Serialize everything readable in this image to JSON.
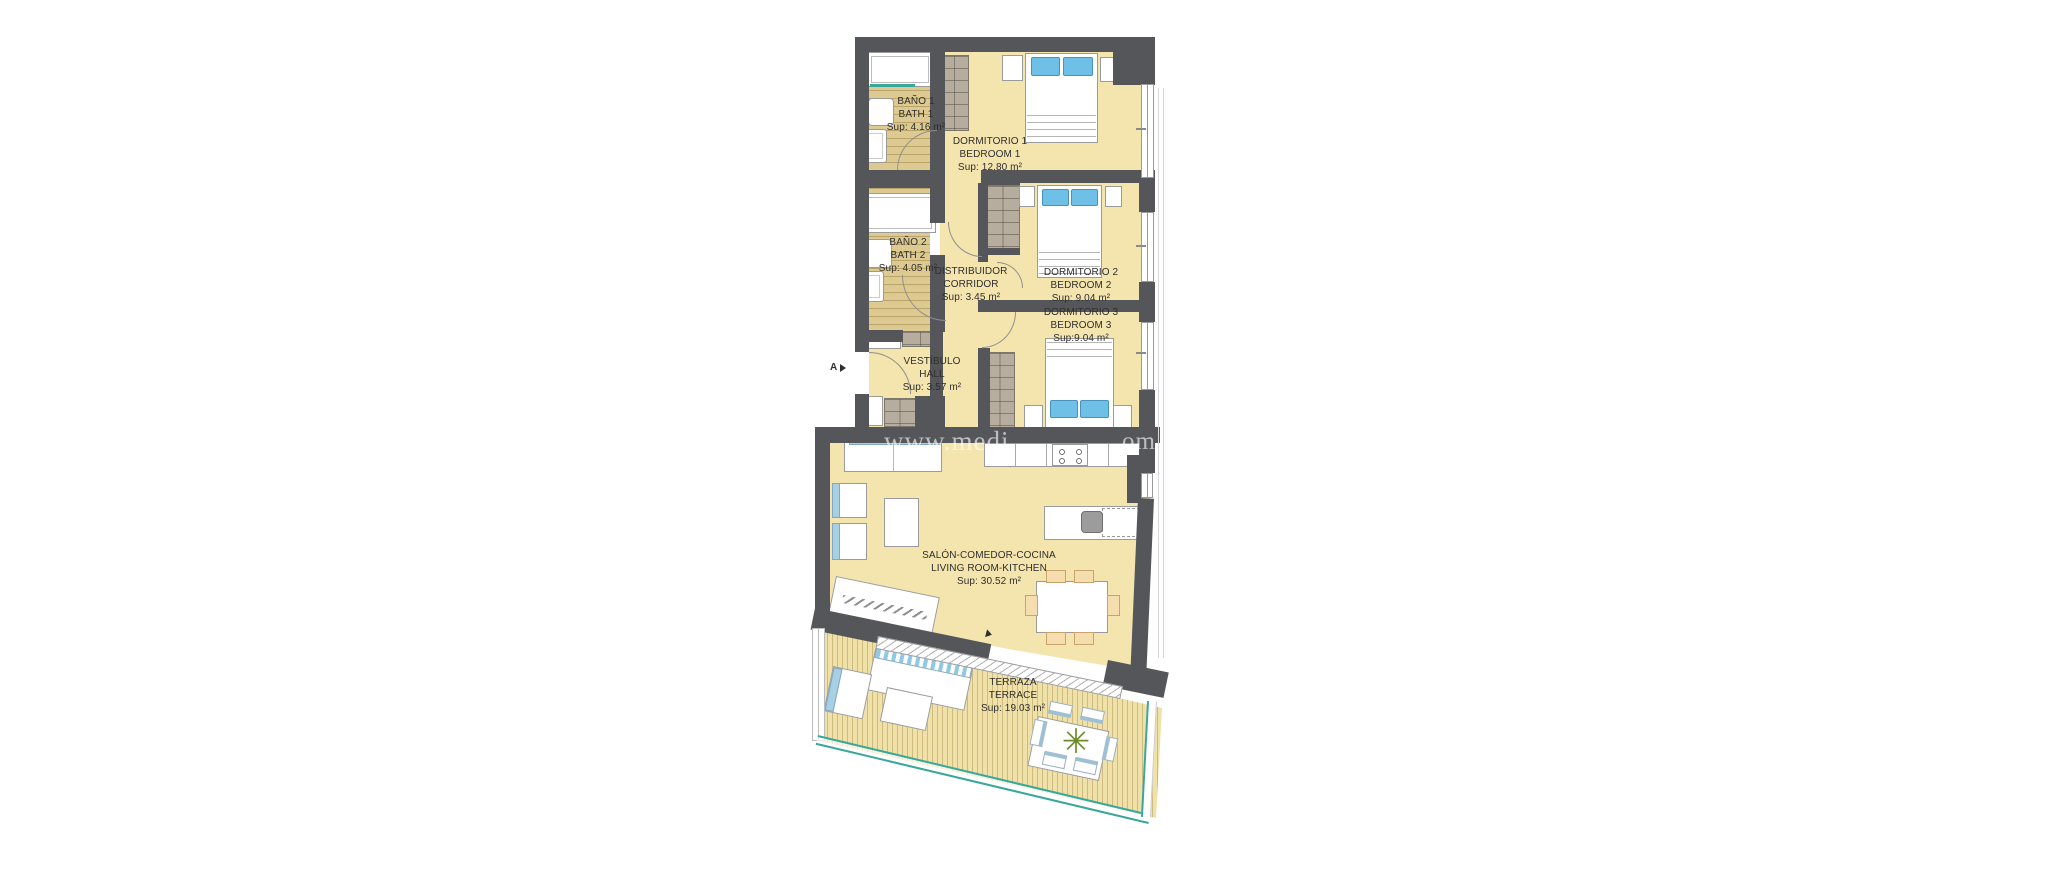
{
  "colors": {
    "wall": "#54565a",
    "floor": "#f4e5ae",
    "wood": "#dcca92",
    "deck": "#f0e1a8",
    "accent_blue": "#6fc0e6",
    "teal": "#3aa79b",
    "watermark": "rgba(255,255,255,0.62)"
  },
  "watermark": {
    "left": "www.medi",
    "right": "om"
  },
  "entrance_marker": {
    "label": "A"
  },
  "rooms": {
    "bano1": {
      "name_es": "BAÑO 1",
      "name_en": "BATH 1",
      "area": "Sup: 4.16 m²"
    },
    "dormitorio1": {
      "name_es": "DORMITORIO 1",
      "name_en": "BEDROOM 1",
      "area": "Sup: 12.80 m²"
    },
    "bano2": {
      "name_es": "BAÑO 2",
      "name_en": "BATH 2",
      "area": "Sup: 4.05 m²"
    },
    "distribuidor": {
      "name_es": "DISTRIBUIDOR",
      "name_en": "CORRIDOR",
      "area": "Sup: 3.45 m²"
    },
    "dormitorio2": {
      "name_es": "DORMITORIO 2",
      "name_en": "BEDROOM 2",
      "area": "Sup: 9.04 m²"
    },
    "dormitorio3": {
      "name_es": "DORMITORIO 3",
      "name_en": "BEDROOM 3",
      "area": "Sup:9.04 m²"
    },
    "vestibulo": {
      "name_es": "VESTÍBULO",
      "name_en": "HALL",
      "area": "Sup: 3.57 m²"
    },
    "salon": {
      "name_es": "SALÓN-COMEDOR-COCINA",
      "name_en": "LIVING ROOM-KITCHEN",
      "area": "Sup: 30.52 m²"
    },
    "terraza": {
      "name_es": "TERRAZA",
      "name_en": "TERRACE",
      "area": "Sup: 19.03 m²"
    }
  },
  "plant_glyph": "✳"
}
